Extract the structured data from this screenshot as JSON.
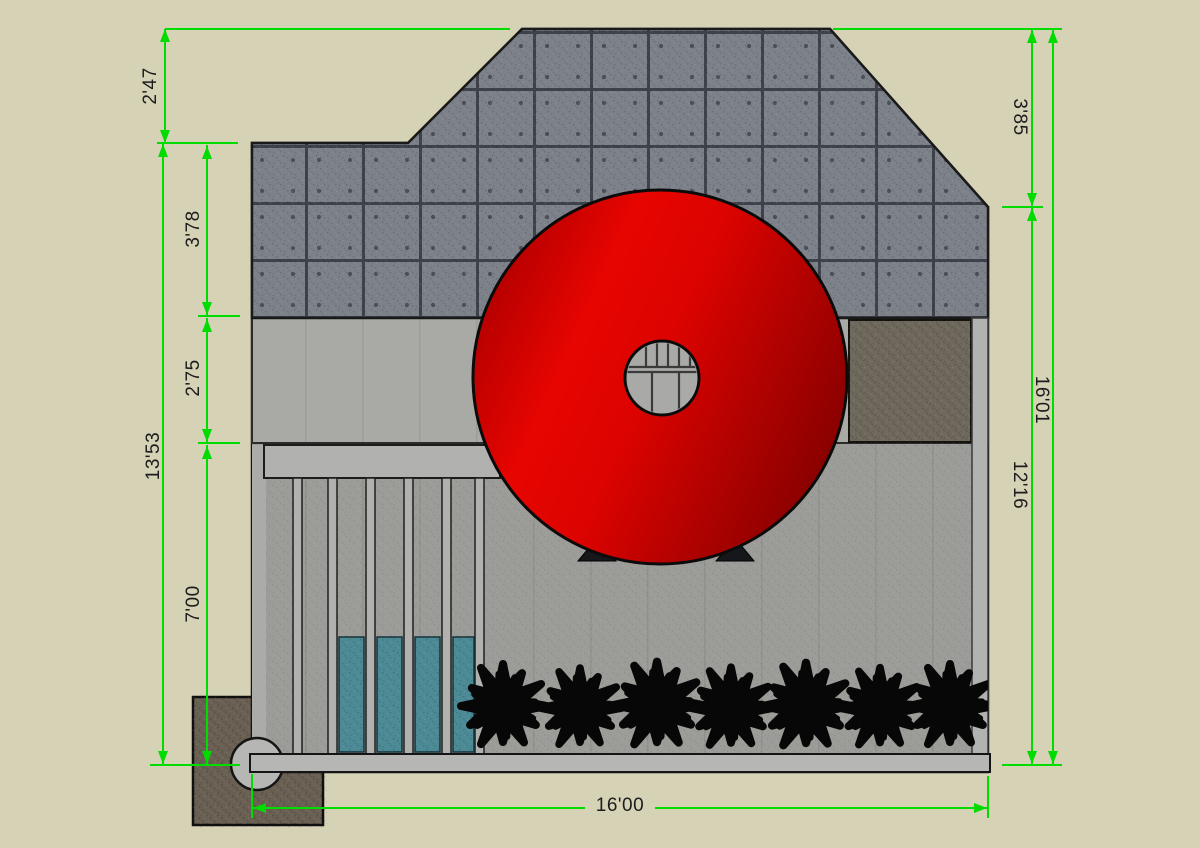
{
  "drawing": {
    "type": "architectural-elevation",
    "dimensions": {
      "left": {
        "roof_offset": "2'47",
        "upper_concrete": "3'78",
        "middle_band": "2'75",
        "overall_left": "13'53",
        "lower_wall": "7'00"
      },
      "right": {
        "roof_slope": "3'85",
        "overall_right": "16'01",
        "body_height": "12'16"
      },
      "bottom": {
        "overall_width": "16'00"
      }
    },
    "colors": {
      "dimension_green": "#00dc00",
      "background_tan": "#d5d2b6",
      "concrete_gray": "#7d828a",
      "mid_band_gray": "#a9a9a5",
      "lower_wall_gray": "#9c9c98",
      "beam_gray": "#b6b6b4",
      "teal_panel": "#4c8a96",
      "brown_panel": "#6f685c",
      "foundation_brown": "#6a6053",
      "disk_red_bright": "#e70500",
      "disk_red_dark": "#740000",
      "plant_black": "#070707"
    }
  }
}
